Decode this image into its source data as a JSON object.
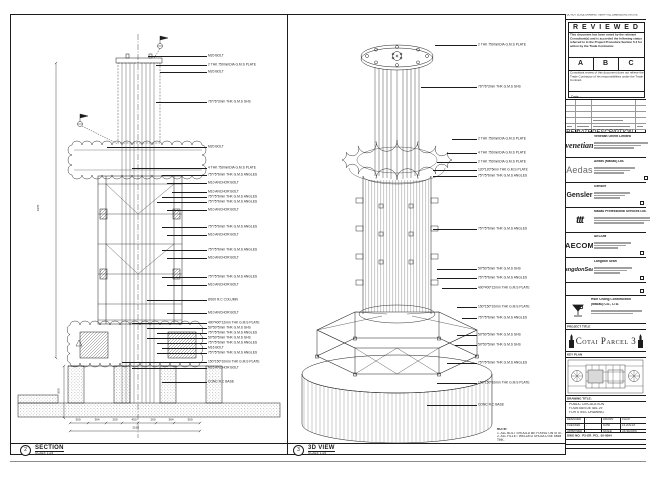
{
  "colors": {
    "line": "#1c1c1c",
    "paper": "#ffffff"
  },
  "section_panel": {
    "bubble_no": "2",
    "title": "SECTION",
    "scale": "SCALE 1:25",
    "dim_left_tall": "1970",
    "dim_left_base": "800",
    "dims_bottom": [
      "300",
      "364",
      "200",
      "450",
      "200",
      "364",
      "300"
    ],
    "dim_total": "2160",
    "callouts": [
      {
        "t": "M20 BOLT",
        "y": 42,
        "len": 59
      },
      {
        "t": "2 THK 750mmDIA G.M.S PLATE",
        "y": 51,
        "len": 51
      },
      {
        "t": "M20 BOLT",
        "y": 58,
        "len": 47
      },
      {
        "t": "76*76*3mm THK G.M.S SHS",
        "y": 88,
        "len": 51
      },
      {
        "t": "M20 BOLT",
        "y": 133,
        "len": 100
      },
      {
        "t": "4 THK 750mmDIA G.M.S PLATE",
        "y": 154,
        "len": 75
      },
      {
        "t": "75*75*6mm THK G.M.S ANGLES",
        "y": 161,
        "len": 45
      },
      {
        "t": "M10 ANCHOR BOLT",
        "y": 169,
        "len": 40
      },
      {
        "t": "M10 ANCHOR BOLT",
        "y": 178,
        "len": 35
      },
      {
        "t": "75*75*6mm THK G.M.S ANGLES",
        "y": 183,
        "len": 45
      },
      {
        "t": "75*75*6mm THK G.M.S ANGLES",
        "y": 188,
        "len": 50
      },
      {
        "t": "M10 ANCHOR BOLT",
        "y": 196,
        "len": 40
      },
      {
        "t": "75*75*6mm THK G.M.S ANGLES",
        "y": 213,
        "len": 45
      },
      {
        "t": "M10 ANCHOR BOLT",
        "y": 221,
        "len": 40
      },
      {
        "t": "75*75*6mm THK G.M.S ANGLES",
        "y": 236,
        "len": 45
      },
      {
        "t": "M10 ANCHOR BOLT",
        "y": 244,
        "len": 40
      },
      {
        "t": "75*75*6mm THK G.M.S ANGLES",
        "y": 263,
        "len": 45
      },
      {
        "t": "M10 ANCHOR BOLT",
        "y": 271,
        "len": 40
      },
      {
        "t": "Ø100 R.C COLUMN",
        "y": 286,
        "len": 60
      },
      {
        "t": "M10 ANCHOR BOLT",
        "y": 299,
        "len": 40
      },
      {
        "t": "400*400*12mm THK G.M.S PLATE",
        "y": 309,
        "len": 75
      },
      {
        "t": "50*50*5mm THK G.M.S SHS",
        "y": 314,
        "len": 60
      },
      {
        "t": "75*75*6mm THK G.M.S ANGLES",
        "y": 319,
        "len": 50
      },
      {
        "t": "50*50*5mm THK G.M.S SHS",
        "y": 324,
        "len": 60
      },
      {
        "t": "75*75*6mm THK G.M.S ANGLES",
        "y": 329,
        "len": 50
      },
      {
        "t": "M16 BOLT",
        "y": 334,
        "len": 45
      },
      {
        "t": "75*75*6mm THK G.M.S ANGLES",
        "y": 339,
        "len": 50
      },
      {
        "t": "150*150*10mm THK G.M.S PLATE",
        "y": 348,
        "len": 85
      },
      {
        "t": "M16 ANCHOR BOLT",
        "y": 354,
        "len": 75
      },
      {
        "t": "CONC R.C BASE",
        "y": 368,
        "len": 45
      }
    ]
  },
  "view3d_panel": {
    "bubble_no": "3",
    "title": "3D VIEW",
    "scale": "SCALE 1:25",
    "callouts": [
      {
        "t": "2 THK 750mmDIA G.M.S PLATE",
        "y": 31,
        "len": 42
      },
      {
        "t": "76*76*3mm THK G.M.S SHS",
        "y": 73,
        "len": 56
      },
      {
        "t": "2 THK 750mmDIA G.M.S PLATE",
        "y": 125,
        "len": 25
      },
      {
        "t": "4 THK 750mmDIA G.M.S PLATE",
        "y": 139,
        "len": 30
      },
      {
        "t": "2 THK 750mmDIA G.M.S PLATE",
        "y": 148,
        "len": 40
      },
      {
        "t": "120*120*5mm THK G.M.S PLATE",
        "y": 156,
        "len": 44
      },
      {
        "t": "75*75*6mm THK G.M.S ANGLES",
        "y": 162,
        "len": 44
      },
      {
        "t": "75*75*6mm THK G.M.S ANGLES",
        "y": 215,
        "len": 44
      },
      {
        "t": "50*50*5mm THK G.M.S SHS",
        "y": 255,
        "len": 40
      },
      {
        "t": "75*75*6mm THK G.M.S ANGLES",
        "y": 264,
        "len": 40
      },
      {
        "t": "400*400*12mm THK G.M.S PLATE",
        "y": 274,
        "len": 35
      },
      {
        "t": "150*150*10mm THK G.M.S PLATE",
        "y": 293,
        "len": 20
      },
      {
        "t": "75*75*6mm THK G.M.S ANGLES",
        "y": 304,
        "len": 15
      },
      {
        "t": "50*50*5mm THK G.M.S SHS",
        "y": 321,
        "len": 20
      },
      {
        "t": "50*50*5mm THK G.M.S SHS",
        "y": 331,
        "len": 22
      },
      {
        "t": "75*75*6mm THK G.M.S ANGLES",
        "y": 349,
        "len": 30
      },
      {
        "t": "150*150*10mm THK G.M.S PLATE",
        "y": 369,
        "len": 40
      },
      {
        "t": "CONC R.C BASE",
        "y": 391,
        "len": 50
      }
    ],
    "notes": {
      "head": "NOTE:",
      "lines": [
        "1. ALL BOLT SHOULD BE FIXING ON SITE.",
        "2. ALL FILLET WELDED SHOULD BE 6MM THK."
      ]
    }
  },
  "titleblock": {
    "top_note": "DO NOT SCALE DRAWING. VERIFY ALL DIMENSIONS ON SITE",
    "reviewed": {
      "title": "R E V I E W E D",
      "para1": "This document has been noted by the relevant Consultant(s) and is accorded the following status referred to in the Project Procedure Section 5.4 for action by the Trade Contractor.",
      "options": [
        "A",
        "B",
        "C"
      ],
      "para2": "Consultant review of this document does not relieve the Trade Contractor of his responsibilities under the Trade Contract.",
      "date_label": "Date :"
    },
    "rev_headers": [
      "REV",
      "DATE",
      "DESCRIPTION"
    ],
    "consultants": [
      {
        "logo_text": "venetian",
        "name": "Venetian Orient Limited"
      },
      {
        "logo_text": "Aedas",
        "name": "Aedas (Macau) Ltd."
      },
      {
        "logo_text": "Gensler",
        "name": "Gensler"
      },
      {
        "logo_text": "ttt",
        "name": "Macau Professional Services Ltd."
      },
      {
        "logo_text": "AECOM",
        "name": "AECOM"
      },
      {
        "logo_text": "LangdonSeah",
        "name": "Langdon Seah"
      }
    ],
    "contractor": {
      "name1": "Hsin Chong Construction",
      "name2": "(Macau) CO., LTD."
    },
    "project": {
      "strip": "PROJECT TITLE",
      "name": "Cotai Parcel 3"
    },
    "keyplan": {
      "strip": "KEY PLAN"
    },
    "drawing": {
      "strip": "DRAWING TITLE:",
      "title_lines": [
        "PUBLIC CIRCULATION",
        "FOUNTAIN DETAIL 29",
        "FOR STEEL DRAWING"
      ],
      "fields": [
        [
          "DESIGNED",
          "-",
          "DRAWN",
          "CHAO"
        ],
        [
          "CHECKED",
          "-",
          "DATE",
          "14-JUN-16"
        ],
        [
          "APPROVED",
          "-",
          "SCALE",
          "AS SHOWN"
        ]
      ],
      "dwg_no_label": "DWG NO.",
      "dwg_no": "P3-GR_PCL_05-0094",
      "rev_label": "REV :",
      "rev": "C",
      "cad_rows": [
        "CAD FILE NAME :",
        "CAD FILE NAME : P3-GR_PCL_05-0094.dwg",
        "REFERENCE CAD FILE NAME :"
      ]
    }
  }
}
